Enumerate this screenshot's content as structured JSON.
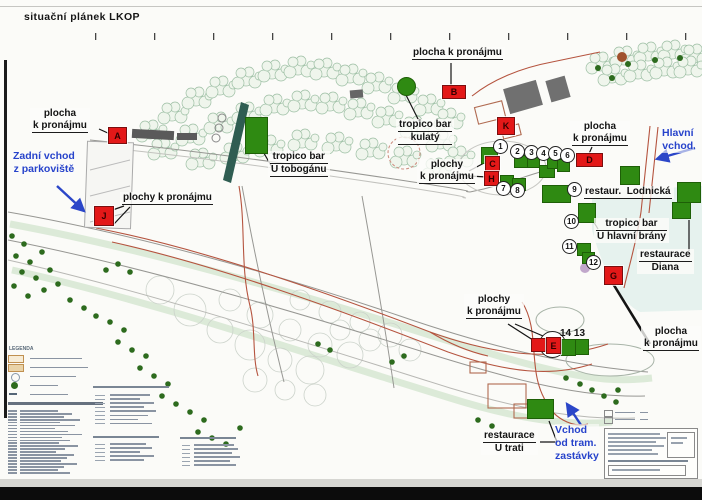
{
  "title": "situační plánek LKOP",
  "colors": {
    "marker_red": "#e31818",
    "site_green": "#2f8a12",
    "entrance_blue": "#2743cb",
    "canopy_green": "#9dbfa4",
    "path_red": "#b5543f"
  },
  "legend": {
    "title": "LEGENDA"
  },
  "callouts": [
    {
      "id": "plocha-a",
      "x": 30,
      "y": 108,
      "lines": [
        "plocha",
        "k pronájmu"
      ],
      "u": [
        1
      ]
    },
    {
      "id": "plochy-j",
      "x": 120,
      "y": 192,
      "lines": [
        "plochy k pronájmu"
      ],
      "u": [
        0
      ]
    },
    {
      "id": "tropico-tobogan",
      "x": 268,
      "y": 151,
      "lines": [
        "tropico bar",
        "U tobogánu"
      ],
      "u": [
        0,
        1
      ]
    },
    {
      "id": "tropico-kulaty",
      "x": 396,
      "y": 119,
      "lines": [
        "tropico bar",
        "kulatý"
      ],
      "u": [
        0,
        1
      ]
    },
    {
      "id": "plocha-b",
      "x": 410,
      "y": 47,
      "lines": [
        "plocha k pronájmu"
      ],
      "u": [
        0
      ]
    },
    {
      "id": "plochy-ch",
      "x": 417,
      "y": 159,
      "lines": [
        "plochy",
        "k pronájmu"
      ],
      "u": [
        1
      ]
    },
    {
      "id": "plocha-d",
      "x": 570,
      "y": 121,
      "lines": [
        "plocha",
        "k pronájmu"
      ],
      "u": [
        1
      ]
    },
    {
      "id": "restaur-lodnicka",
      "x": 582,
      "y": 186,
      "lines": [
        "restaur.  Lodnická"
      ],
      "u": [
        0
      ]
    },
    {
      "id": "tropico-brany",
      "x": 594,
      "y": 218,
      "lines": [
        "tropico bar",
        "U hlavní brány"
      ],
      "u": [
        0
      ]
    },
    {
      "id": "restaurace-diana",
      "x": 637,
      "y": 249,
      "lines": [
        "restaurace",
        "Diana"
      ],
      "u": [
        0
      ]
    },
    {
      "id": "plochy-e",
      "x": 464,
      "y": 294,
      "lines": [
        "plochy",
        "k pronájmu"
      ],
      "u": [
        1
      ]
    },
    {
      "id": "plocha-g",
      "x": 641,
      "y": 326,
      "lines": [
        "plocha",
        "k pronájmu"
      ],
      "u": [
        1
      ]
    },
    {
      "id": "restaurace-utrati",
      "x": 481,
      "y": 430,
      "lines": [
        "restaurace",
        "U trati"
      ],
      "u": [
        0
      ]
    },
    {
      "id": "sites-14-13",
      "x": 559,
      "y": 328,
      "lines": [
        "14 13"
      ],
      "u": [],
      "plain": true
    }
  ],
  "entrances": [
    {
      "id": "zadni-vchod",
      "x": 13,
      "y": 150,
      "align": "center",
      "lines": [
        "Zadní vchod",
        "z parkoviště"
      ]
    },
    {
      "id": "hlavni-vchod",
      "x": 662,
      "y": 127,
      "align": "center",
      "lines": [
        "Hlavní",
        "vchod"
      ]
    },
    {
      "id": "vchod-tram",
      "x": 555,
      "y": 424,
      "align": "left",
      "lines": [
        "Vchod",
        "od tram.",
        "zastávky"
      ]
    }
  ],
  "letter_markers": [
    {
      "letter": "A",
      "x": 108,
      "y": 127,
      "w": 17,
      "h": 15
    },
    {
      "letter": "B",
      "x": 442,
      "y": 85,
      "w": 22,
      "h": 12
    },
    {
      "letter": "C",
      "x": 485,
      "y": 156,
      "w": 13,
      "h": 14
    },
    {
      "letter": "D",
      "x": 576,
      "y": 153,
      "w": 25,
      "h": 12
    },
    {
      "letter": "E",
      "x": 546,
      "y": 337,
      "w": 13,
      "h": 15
    },
    {
      "letter": "G",
      "x": 604,
      "y": 266,
      "w": 17,
      "h": 17
    },
    {
      "letter": "H",
      "x": 484,
      "y": 171,
      "w": 13,
      "h": 13
    },
    {
      "letter": "J",
      "x": 94,
      "y": 206,
      "w": 18,
      "h": 18
    },
    {
      "letter": "K",
      "x": 497,
      "y": 117,
      "w": 16,
      "h": 16
    }
  ],
  "number_markers": [
    {
      "n": "1",
      "cx": 500,
      "cy": 146
    },
    {
      "n": "2",
      "cx": 517,
      "cy": 151
    },
    {
      "n": "3",
      "cx": 531,
      "cy": 152
    },
    {
      "n": "4",
      "cx": 543,
      "cy": 153
    },
    {
      "n": "5",
      "cx": 555,
      "cy": 153
    },
    {
      "n": "6",
      "cx": 567,
      "cy": 155
    },
    {
      "n": "7",
      "cx": 503,
      "cy": 188
    },
    {
      "n": "8",
      "cx": 517,
      "cy": 190
    },
    {
      "n": "9",
      "cx": 574,
      "cy": 189
    },
    {
      "n": "10",
      "cx": 571,
      "cy": 221
    },
    {
      "n": "11",
      "cx": 569,
      "cy": 246
    },
    {
      "n": "12",
      "cx": 593,
      "cy": 262
    }
  ],
  "green_sites": [
    {
      "x": 481,
      "y": 147,
      "w": 15,
      "h": 15
    },
    {
      "x": 514,
      "y": 155,
      "w": 12,
      "h": 11
    },
    {
      "x": 527,
      "y": 156,
      "w": 11,
      "h": 10
    },
    {
      "x": 539,
      "y": 165,
      "w": 14,
      "h": 11
    },
    {
      "x": 547,
      "y": 157,
      "w": 11,
      "h": 10
    },
    {
      "x": 557,
      "y": 159,
      "w": 11,
      "h": 11
    },
    {
      "x": 500,
      "y": 175,
      "w": 12,
      "h": 12
    },
    {
      "x": 512,
      "y": 178,
      "w": 12,
      "h": 11
    },
    {
      "x": 542,
      "y": 185,
      "w": 27,
      "h": 16
    },
    {
      "x": 620,
      "y": 166,
      "w": 18,
      "h": 17
    },
    {
      "x": 677,
      "y": 182,
      "w": 22,
      "h": 19
    },
    {
      "x": 578,
      "y": 203,
      "w": 16,
      "h": 18
    },
    {
      "x": 672,
      "y": 202,
      "w": 17,
      "h": 15
    },
    {
      "x": 577,
      "y": 243,
      "w": 12,
      "h": 11
    },
    {
      "x": 582,
      "y": 252,
      "w": 11,
      "h": 10
    },
    {
      "x": 561,
      "y": 339,
      "w": 13,
      "h": 15
    },
    {
      "x": 575,
      "y": 339,
      "w": 12,
      "h": 14
    },
    {
      "x": 527,
      "y": 399,
      "w": 25,
      "h": 18
    },
    {
      "x": 245,
      "y": 117,
      "w": 21,
      "h": 35
    }
  ]
}
